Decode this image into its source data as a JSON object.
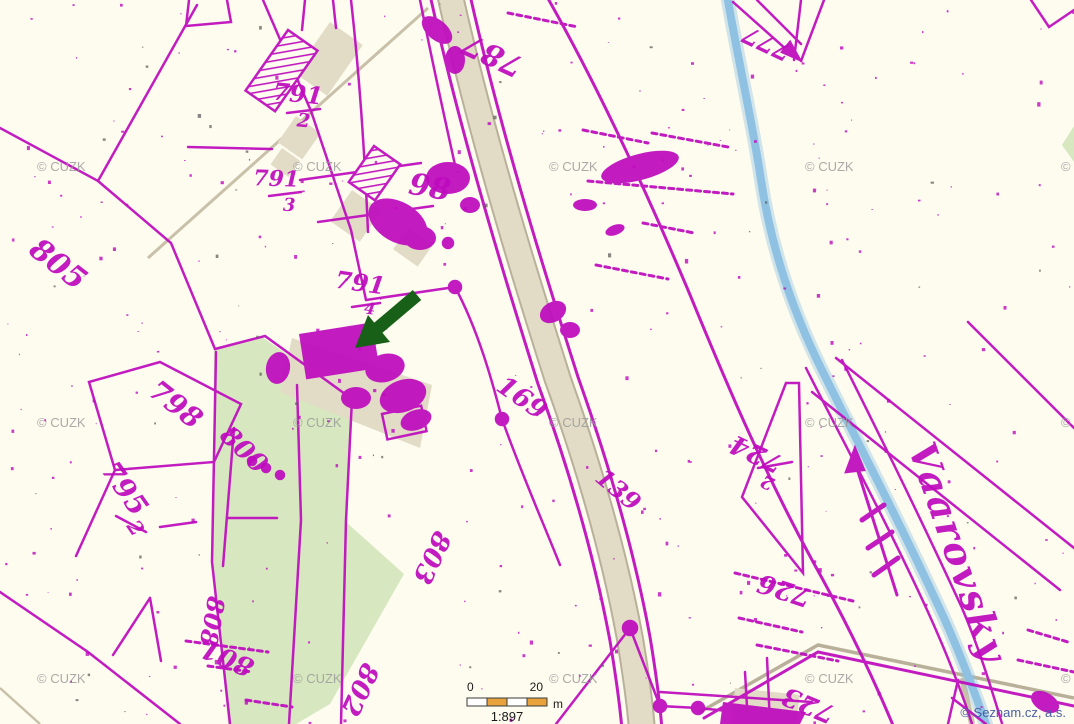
{
  "map": {
    "type": "historic-cadastral-overlay",
    "colors": {
      "background": "#FDFCEF",
      "cadastre_magenta": "#BE0ABE",
      "field_green": "#D7E7BF",
      "road_tan": "#E2DBC6",
      "road_edge": "#B9B09A",
      "stream_blue": "#8FC1E2",
      "arrow_green": "#186018",
      "watermark_gray": "#9C9C9C",
      "credit_blue": "#4A5FA5",
      "scalebar_orange": "#E7A23C",
      "ink": "#1A1A1A"
    },
    "parcel_labels": [
      {
        "text": "787",
        "x": 497,
        "y": 46,
        "rot": 205,
        "size": 30
      },
      {
        "text": "791",
        "x": 297,
        "y": 102,
        "rot": 6,
        "size": 24
      },
      {
        "text": "2",
        "x": 303,
        "y": 127,
        "rot": 6,
        "size": 19
      },
      {
        "text": "791",
        "x": 276,
        "y": 186,
        "rot": 2,
        "size": 22
      },
      {
        "text": "3",
        "x": 289,
        "y": 211,
        "rot": 2,
        "size": 18
      },
      {
        "text": "98",
        "x": 428,
        "y": 197,
        "rot": 10,
        "size": 30
      },
      {
        "text": "805",
        "x": 52,
        "y": 272,
        "rot": 38,
        "size": 30
      },
      {
        "text": "798",
        "x": 170,
        "y": 412,
        "rot": 38,
        "size": 28
      },
      {
        "text": "795",
        "x": 117,
        "y": 494,
        "rot": 55,
        "size": 28
      },
      {
        "text": "2",
        "x": 130,
        "y": 532,
        "rot": 55,
        "size": 20
      },
      {
        "text": "800",
        "x": 238,
        "y": 456,
        "rot": 44,
        "size": 26
      },
      {
        "text": "791",
        "x": 359,
        "y": 291,
        "rot": 8,
        "size": 24
      },
      {
        "text": "4",
        "x": 369,
        "y": 314,
        "rot": 8,
        "size": 16
      },
      {
        "text": "169",
        "x": 517,
        "y": 405,
        "rot": 35,
        "size": 26
      },
      {
        "text": "139",
        "x": 613,
        "y": 496,
        "rot": 40,
        "size": 24
      },
      {
        "text": "724",
        "x": 760,
        "y": 446,
        "rot": 205,
        "size": 26
      },
      {
        "text": "2",
        "x": 770,
        "y": 477,
        "rot": 205,
        "size": 18
      },
      {
        "text": "726",
        "x": 787,
        "y": 582,
        "rot": 198,
        "size": 26
      },
      {
        "text": "723",
        "x": 812,
        "y": 697,
        "rot": 203,
        "size": 26
      },
      {
        "text": "801",
        "x": 231,
        "y": 650,
        "rot": 204,
        "size": 26
      },
      {
        "text": "802",
        "x": 352,
        "y": 686,
        "rot": 115,
        "size": 26
      },
      {
        "text": "803",
        "x": 424,
        "y": 554,
        "rot": 115,
        "size": 26
      },
      {
        "text": "808",
        "x": 204,
        "y": 620,
        "rot": 100,
        "size": 24
      },
      {
        "text": "777",
        "x": 770,
        "y": 36,
        "rot": 205,
        "size": 24
      }
    ],
    "stream_label": {
      "text": "Vaarovsky",
      "x": 908,
      "y": 448,
      "rot": 71,
      "size": 38
    },
    "watermark": {
      "text": "© CUZK",
      "cols": [
        37,
        293,
        549,
        805,
        1061
      ],
      "rows": [
        171,
        427,
        683
      ]
    },
    "credit": {
      "text": "© Seznam.cz, a.s.",
      "x": 1066,
      "y": 717
    },
    "scalebar": {
      "label_zero": "0",
      "label_twenty": "20",
      "unit": "m",
      "ratio": "1:897"
    },
    "annotation": {
      "name": "green-arrow",
      "color": "#186018"
    }
  }
}
